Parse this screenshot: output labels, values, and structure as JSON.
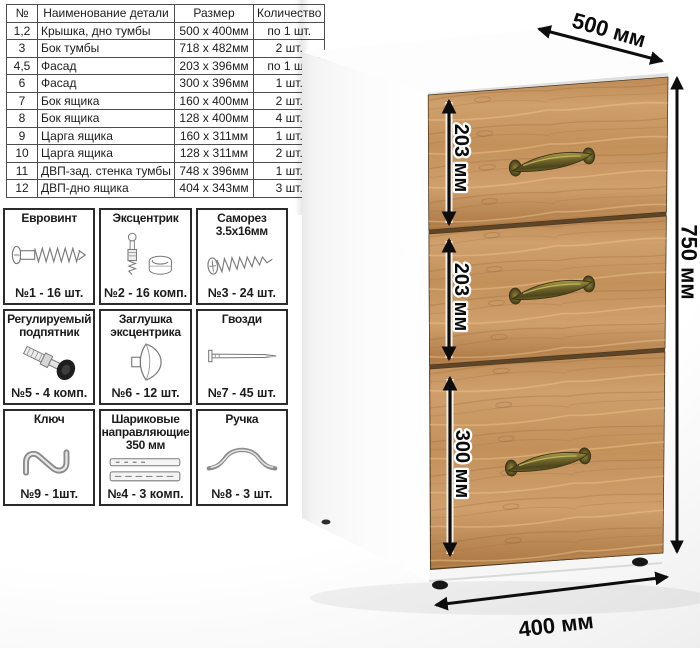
{
  "parts_table": {
    "headers": {
      "num": "№",
      "name": "Наименование детали",
      "size": "Размер",
      "qty": "Количество"
    },
    "rows": [
      {
        "num": "1,2",
        "name": "Крышка, дно тумбы",
        "size": "500 x 400мм",
        "qty": "по 1 шт."
      },
      {
        "num": "3",
        "name": "Бок тумбы",
        "size": "718 x 482мм",
        "qty": "2 шт."
      },
      {
        "num": "4,5",
        "name": "Фасад",
        "size": "203 x 396мм",
        "qty": "по 1 шт."
      },
      {
        "num": "6",
        "name": "Фасад",
        "size": "300 x 396мм",
        "qty": "1 шт."
      },
      {
        "num": "7",
        "name": "Бок ящика",
        "size": "160 x 400мм",
        "qty": "2 шт."
      },
      {
        "num": "8",
        "name": "Бок ящика",
        "size": "128 x 400мм",
        "qty": "4 шт."
      },
      {
        "num": "9",
        "name": "Царга ящика",
        "size": "160 x 311мм",
        "qty": "1 шт."
      },
      {
        "num": "10",
        "name": "Царга ящика",
        "size": "128 x 311мм",
        "qty": "2 шт."
      },
      {
        "num": "11",
        "name": "ДВП-зад. стенка тумбы",
        "size": "748 x 396мм",
        "qty": "1 шт."
      },
      {
        "num": "12",
        "name": "ДВП-дно ящика",
        "size": "404 x 343мм",
        "qty": "3 шт."
      }
    ]
  },
  "hardware": {
    "items": [
      {
        "title": "Евровинт",
        "count": "№1 - 16 шт.",
        "icon": "confirmat-screw"
      },
      {
        "title": "Эксцентрик",
        "count": "№2 - 16 комп.",
        "icon": "cam-lock"
      },
      {
        "title": "Саморез 3.5х16мм",
        "count": "№3 - 24 шт.",
        "icon": "self-tapping-screw"
      },
      {
        "title": "Регулируемый подпятник",
        "count": "№5 - 4 комп.",
        "icon": "adjustable-foot"
      },
      {
        "title": "Заглушка эксцентрика",
        "count": "№6 - 12 шт.",
        "icon": "cam-cap"
      },
      {
        "title": "Гвозди",
        "count": "№7 - 45 шт.",
        "icon": "nail"
      },
      {
        "title": "Ключ",
        "count": "№9 - 1шт.",
        "icon": "z-key"
      },
      {
        "title": "Шариковые направляющие 350 мм",
        "count": "№4 - 3 комп.",
        "icon": "ball-bearing-slides"
      },
      {
        "title": "Ручка",
        "count": "№8 - 3 шт.",
        "icon": "bow-handle"
      }
    ]
  },
  "diagram": {
    "top_width": "500 мм",
    "height": "750 мм",
    "bottom_depth": "400 мм",
    "drawer_top": "203 мм",
    "drawer_middle": "203 мм",
    "drawer_bottom": "300 мм"
  },
  "colors": {
    "wood_base": "#c79763",
    "wood_dark": "#a87746",
    "wood_light": "#ddb07c",
    "brass": "#6e632a",
    "dimension": "#0d0d0d",
    "cabinet_body": "#ffffff"
  }
}
